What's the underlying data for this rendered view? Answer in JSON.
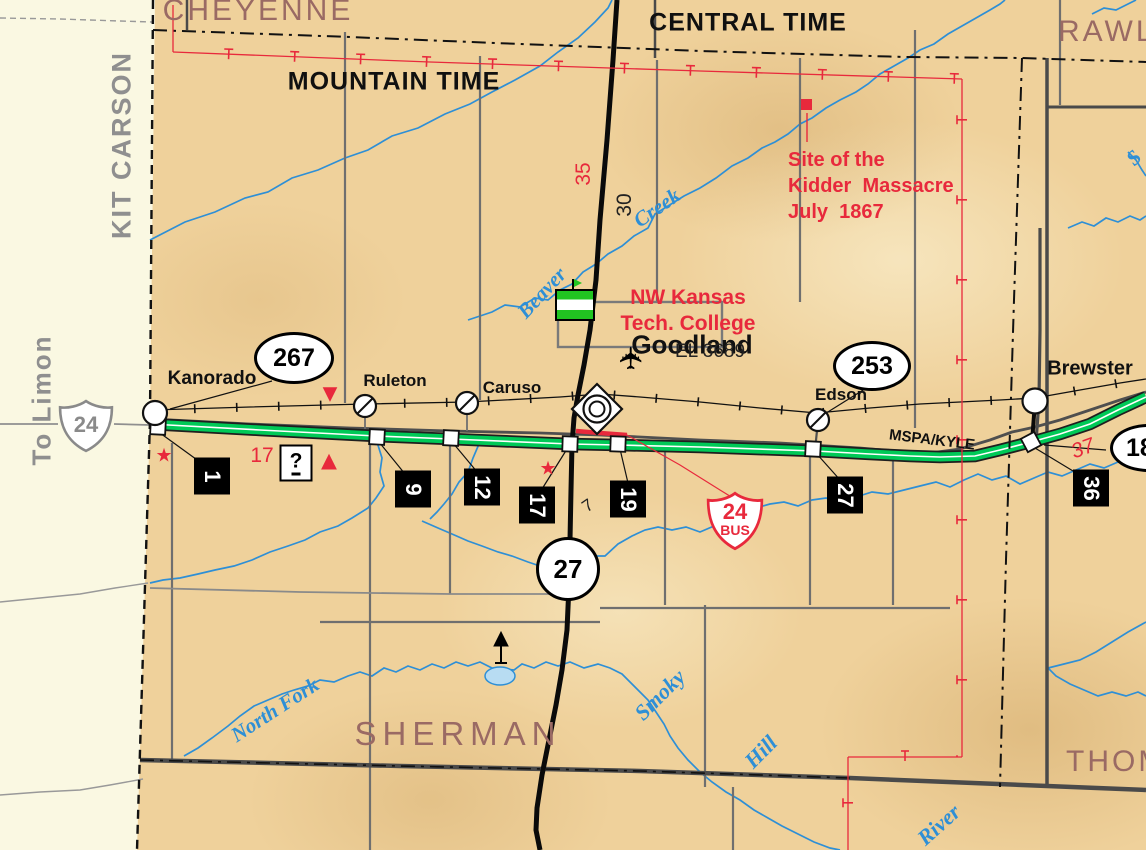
{
  "colors": {
    "kansas_tan": "#efd19b",
    "colorado_cream": "#faf8e2",
    "interstate_green": "#00c957",
    "highway_red": "#e8293c",
    "water_blue": "#2e8fd6",
    "county_brown": "#9a6a64",
    "road_black": "#111111",
    "road_gray": "#6f6f6f"
  },
  "colorado": {
    "county": "KIT CARSON",
    "destination": "To Limon"
  },
  "counties": {
    "cheyenne": "CHEYENNE",
    "rawlins": "RAWL",
    "sherman": "SHERMAN",
    "thomas": "THOM"
  },
  "timezones": {
    "mountain": "MOUNTAIN TIME",
    "central": "CENTRAL TIME"
  },
  "towns": {
    "kanorado": "Kanorado",
    "ruleton": "Ruleton",
    "caruso": "Caruso",
    "goodland": "Goodland",
    "edson": "Edson",
    "brewster": "Brewster"
  },
  "shields": {
    "us24": "24",
    "k267": "267",
    "k253": "253",
    "k27": "27",
    "k18": "18",
    "bus24_num": "24",
    "bus24_suffix": "BUS"
  },
  "exits": [
    "1",
    "9",
    "12",
    "17",
    "19",
    "27",
    "36"
  ],
  "route_numbers": {
    "red_17": "17",
    "red_35": "35",
    "red_37": "37",
    "black_30": "30",
    "black_7": "7"
  },
  "pois": {
    "kidder_site": "Site of the\nKidder  Massacre\nJuly  1867",
    "college": "NW Kansas\nTech. College",
    "elevation": "EL 3689",
    "railroad_name": "MSPA/KYLE"
  },
  "waterways": {
    "beaver": "Beaver",
    "creek": "Creek",
    "north_fork": "North Fork",
    "smoky": "Smoky",
    "hill": "Hill",
    "river": "River",
    "s_partial": "S"
  },
  "symbols": {
    "info": "?",
    "airport": "✈",
    "star": "★",
    "triangle_up": "▲",
    "triangle_down": "▼"
  }
}
